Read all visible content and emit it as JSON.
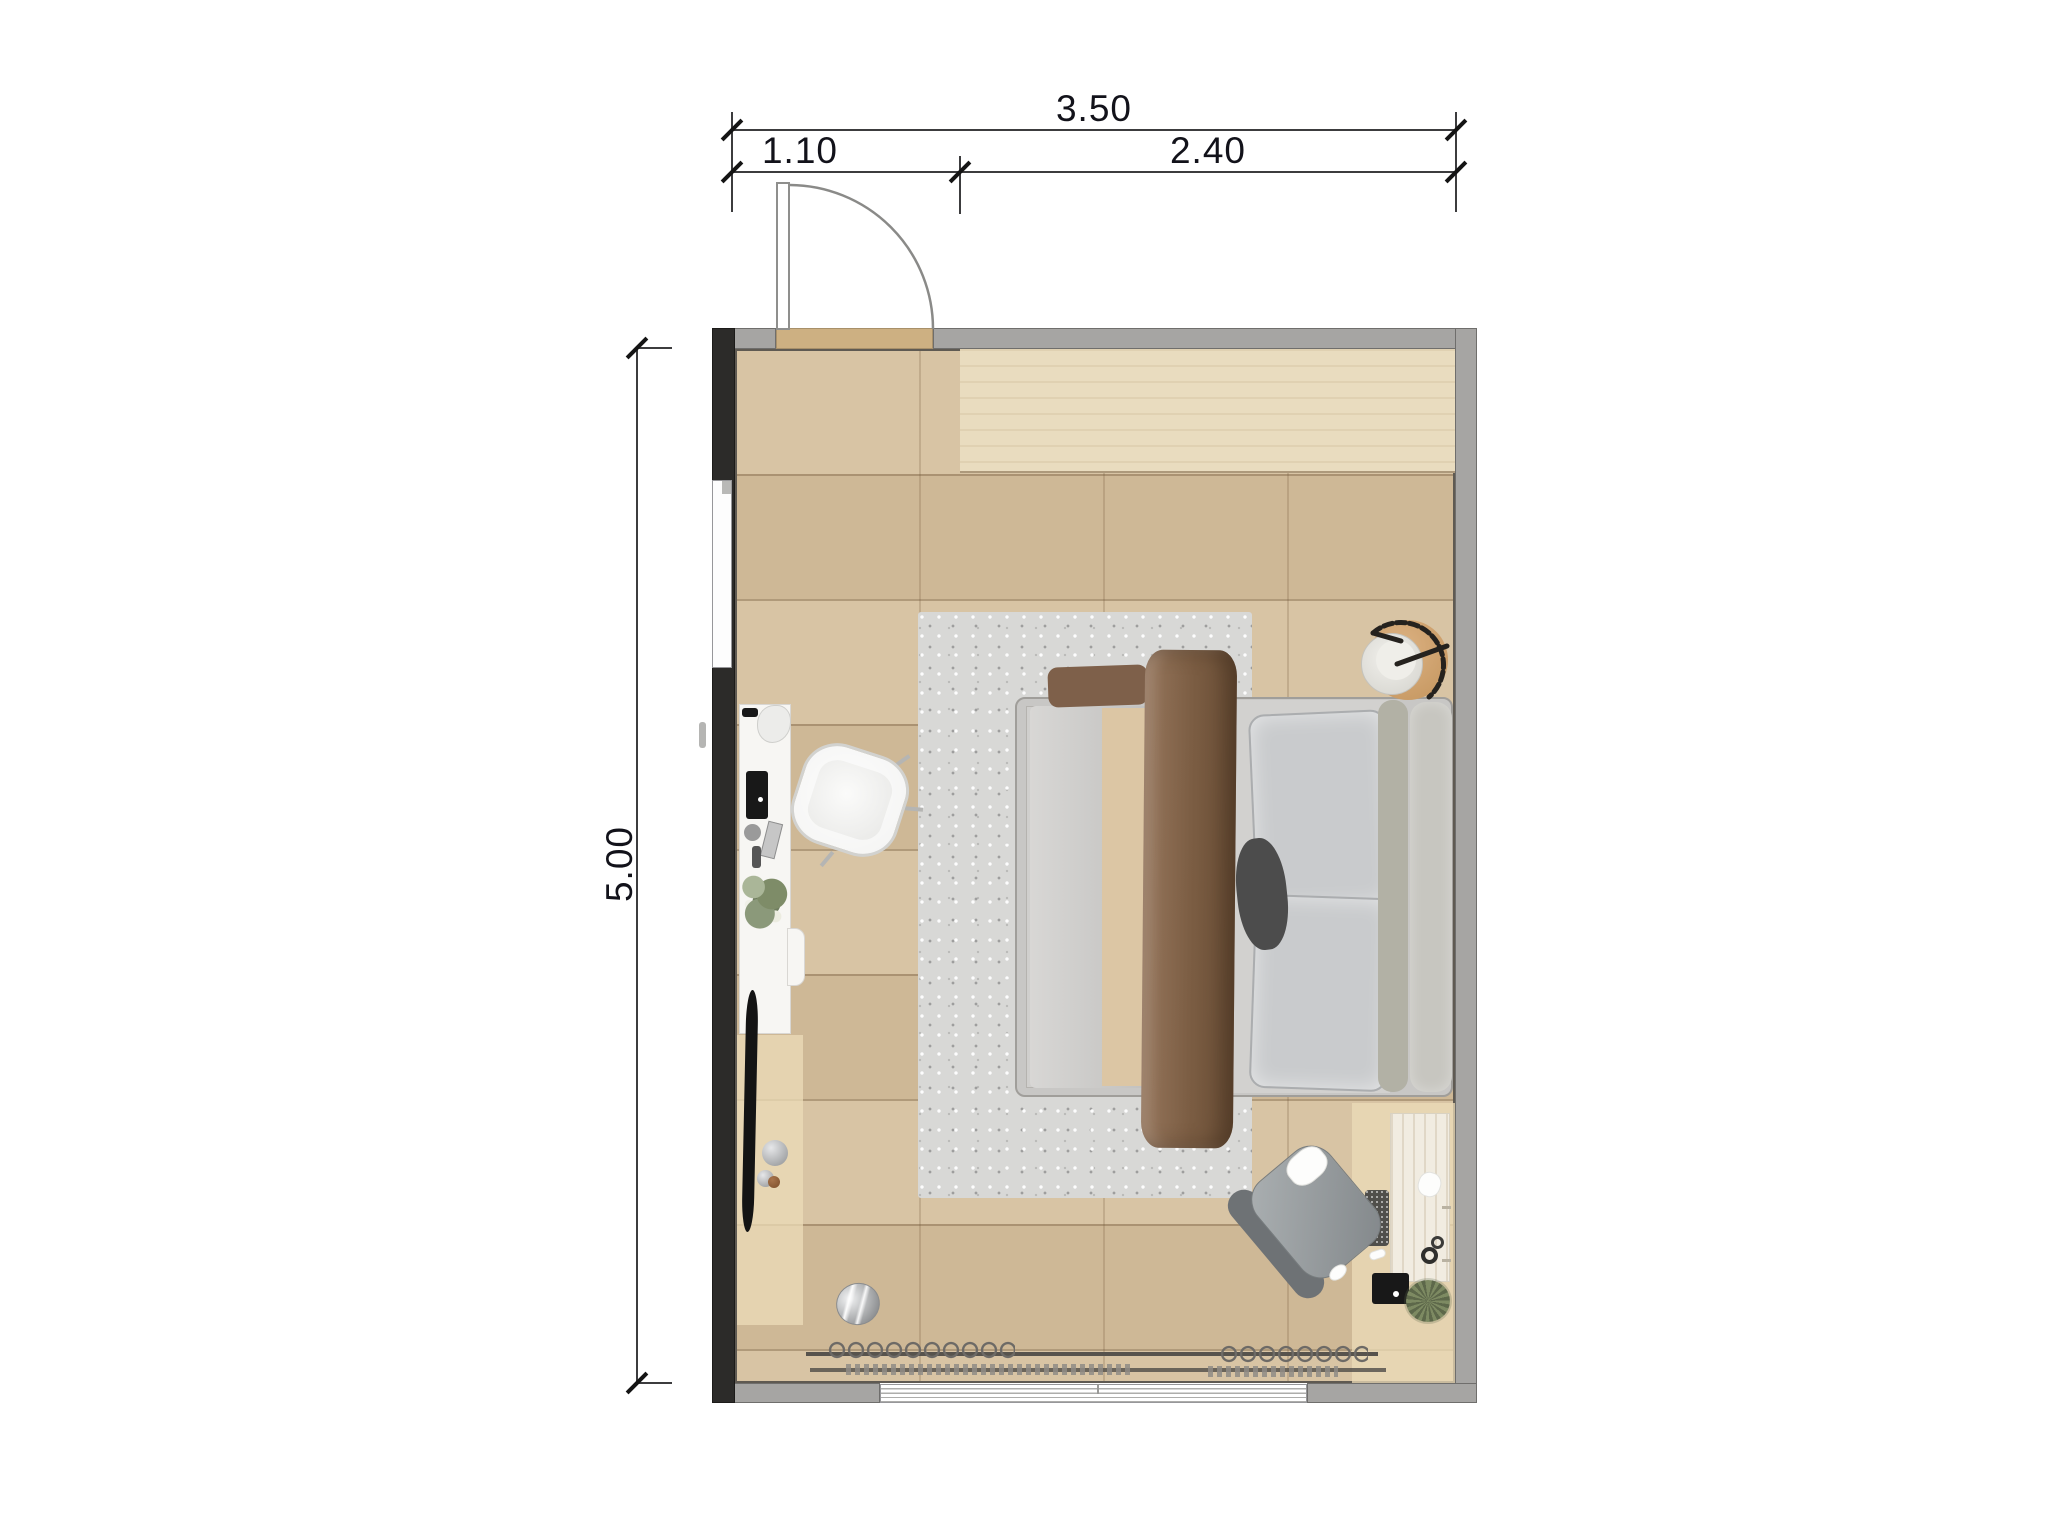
{
  "page": {
    "type": "bedroom-floor-plan",
    "background": "#ffffff"
  },
  "dimensions": {
    "top_total": "3.50",
    "top_segment_left": "1.10",
    "top_segment_right": "2.40",
    "side_height": "5.00"
  },
  "palette": {
    "wall_gray": "#a6a5a3",
    "wall_dark": "#2c2b29",
    "floor_wood": "#d5bf9d",
    "floor_light": "#e9dcbf",
    "rug_gray": "#d8d8d6",
    "bed_frame": "#c8c7c5",
    "duvet_brown": "#7a5c42",
    "blanket_tan": "#dcc6a4",
    "pillow_gray": "#c9cbcd",
    "dimension_ink": "#12121a"
  },
  "objects": {
    "door": "hinged-door-top-left",
    "left_window": "window-left-wall",
    "bottom_window": "window-bottom-wall",
    "bed": "double-bed",
    "rug": "area-rug",
    "desk_left": "desk-left-wall",
    "chair_left": "white-desk-chair",
    "desk_right": "vanity-desk-right",
    "chair_right": "gray-armchair",
    "wardrobe": "open-wardrobe-rails",
    "side_table": "round-bedside-table-with-lamp"
  }
}
